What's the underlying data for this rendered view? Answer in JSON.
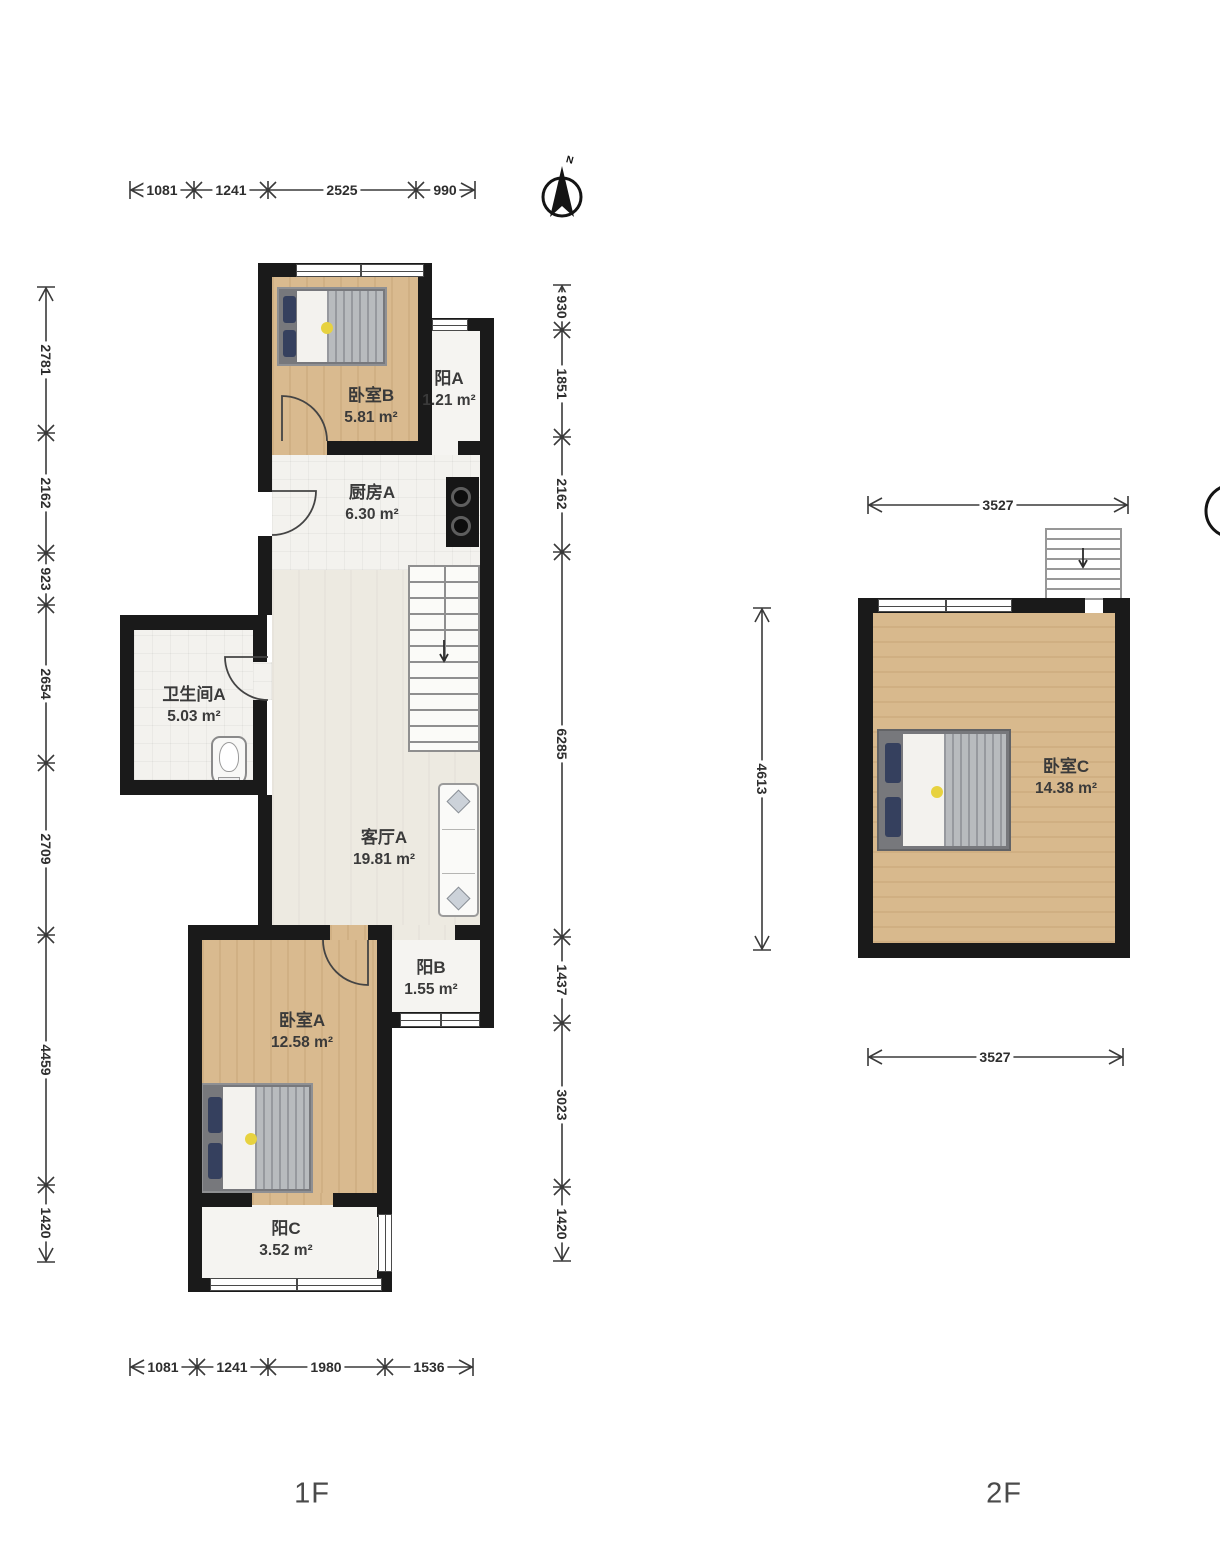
{
  "page": {
    "floor1_label": "1F",
    "floor2_label": "2F",
    "north_label": "N"
  },
  "floor1": {
    "rooms": {
      "bedroomB": {
        "name": "卧室B",
        "area": "5.81 m²"
      },
      "balconyA": {
        "name": "阳A",
        "area": "1.21 m²"
      },
      "kitchenA": {
        "name": "厨房A",
        "area": "6.30 m²"
      },
      "bathroomA": {
        "name": "卫生间A",
        "area": "5.03 m²"
      },
      "livingA": {
        "name": "客厅A",
        "area": "19.81 m²"
      },
      "balconyB": {
        "name": "阳B",
        "area": "1.55 m²"
      },
      "bedroomA": {
        "name": "卧室A",
        "area": "12.58 m²"
      },
      "balconyC": {
        "name": "阳C",
        "area": "3.52 m²"
      }
    },
    "dims": {
      "top": [
        "1081",
        "1241",
        "2525",
        "990"
      ],
      "bottom": [
        "1081",
        "1241",
        "1980",
        "1536"
      ],
      "left": [
        "2781",
        "2162",
        "923",
        "2654",
        "2709",
        "4459",
        "1420"
      ],
      "inner": [
        "930",
        "1851",
        "2162",
        "6285",
        "1437",
        "3023",
        "1420"
      ]
    }
  },
  "floor2": {
    "rooms": {
      "bedroomC": {
        "name": "卧室C",
        "area": "14.38 m²"
      }
    },
    "dims": {
      "top": "3527",
      "bottom": "3527",
      "left": "4613"
    }
  },
  "colors": {
    "wall": "#1a1a1a",
    "wood_floor": "#d9ba8f",
    "tile_floor": "#f3f2ee",
    "pillow_navy": "#35405e",
    "blanket_gray": "#b8bbbe",
    "accent_yellow": "#e7d23f"
  }
}
